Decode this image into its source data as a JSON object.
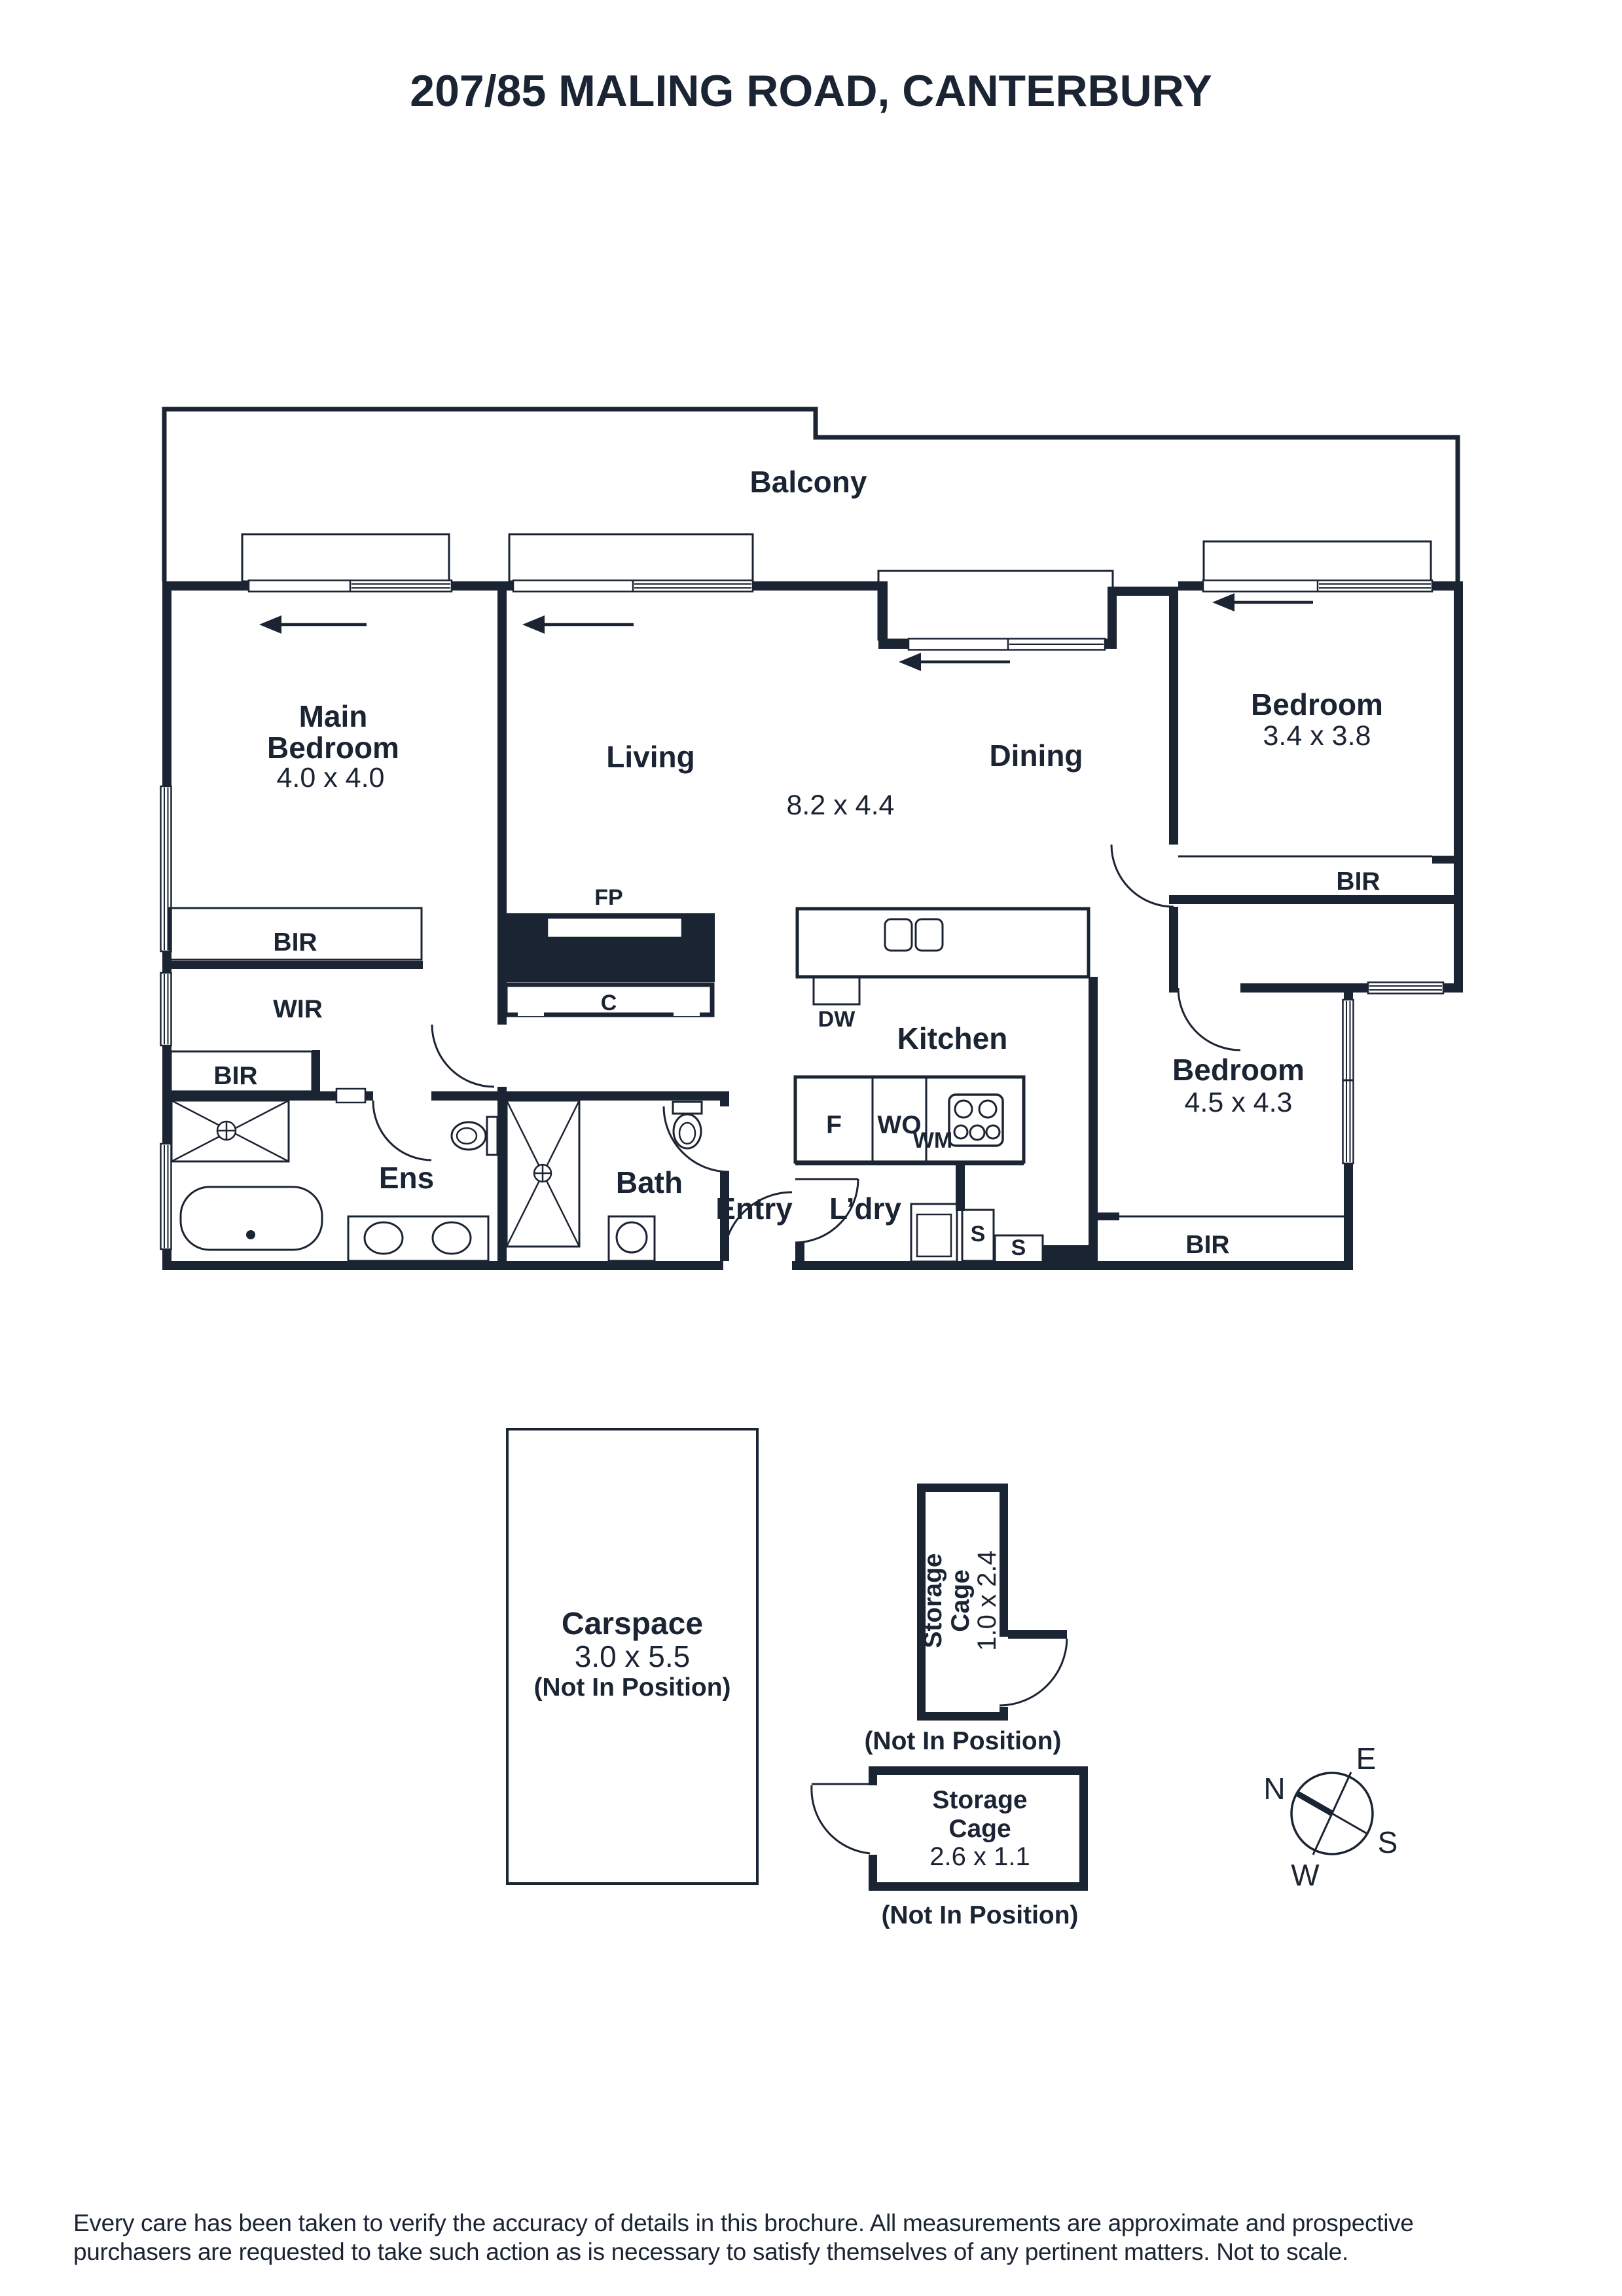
{
  "title": "207/85 MALING ROAD, CANTERBURY",
  "plan": {
    "balcony": "Balcony",
    "main_bedroom": {
      "line1": "Main",
      "line2": "Bedroom",
      "dims": "4.0 x 4.0"
    },
    "living": "Living",
    "dining": "Dining",
    "living_dining_dims": "8.2 x 4.4",
    "bedroom2": {
      "label": "Bedroom",
      "dims": "3.4 x 3.8"
    },
    "bedroom3": {
      "label": "Bedroom",
      "dims": "4.5 x 4.3"
    },
    "kitchen": "Kitchen",
    "wir": "WIR",
    "bir_main": "BIR",
    "bir_wir": "BIR",
    "bir_bed2": "BIR",
    "bir_bed3": "BIR",
    "fp": "FP",
    "c": "C",
    "dw": "DW",
    "f": "F",
    "wo": "WO",
    "wm": "WM",
    "s1": "S",
    "s2": "S",
    "ens": "Ens",
    "bath": "Bath",
    "entry": "Entry",
    "ldry": "L’dry"
  },
  "outbuildings": {
    "carspace": {
      "label": "Carspace",
      "dims": "3.0 x 5.5",
      "note": "(Not In Position)"
    },
    "storage1": {
      "line1": "Storage",
      "line2": "Cage",
      "dims": "1.0 x 2.4",
      "note": "(Not In Position)"
    },
    "storage2": {
      "line1": "Storage",
      "line2": "Cage",
      "dims": "2.6 x 1.1",
      "note": "(Not In Position)"
    }
  },
  "compass": {
    "n": "N",
    "e": "E",
    "s": "S",
    "w": "W"
  },
  "disclaimer": {
    "line1": "Every care has been taken to verify the accuracy of details in this brochure. All measurements are approximate and prospective",
    "line2": "purchasers are requested to take such action as is necessary to satisfy themselves of any pertinent matters. Not to scale."
  },
  "colors": {
    "ink": "#1b2433",
    "background": "#ffffff"
  }
}
